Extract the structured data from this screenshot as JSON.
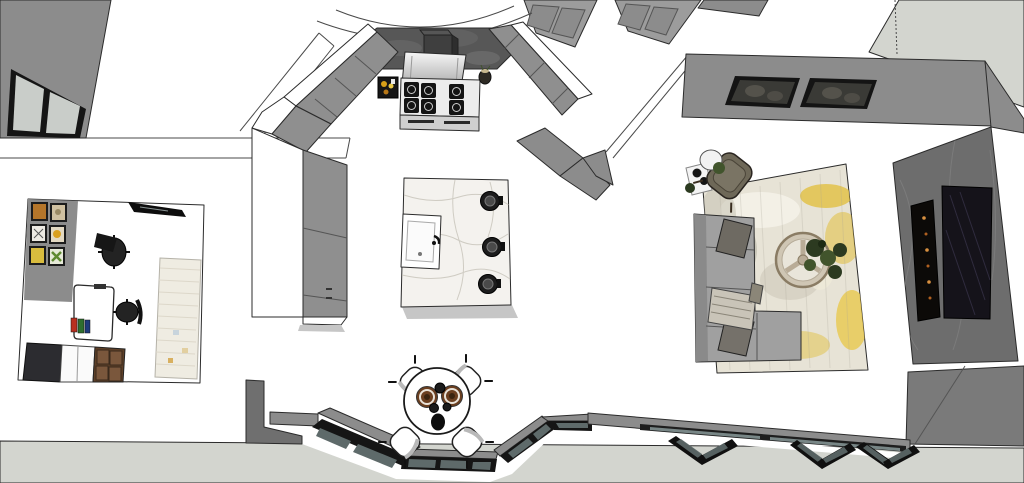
{
  "scene": {
    "label": "3D top-down interior floor plan viewport",
    "rooms": {
      "kitchen": {
        "objects": [
          "range-cooker",
          "range-hood",
          "hood-duct",
          "marble-backsplash",
          "spice-tray",
          "utensil-crock",
          "left-counter",
          "right-counter",
          "kitchen-island",
          "island-sink",
          "bar-stool",
          "bar-stool",
          "bar-stool"
        ]
      },
      "dining": {
        "objects": [
          "round-dining-table",
          "dining-chair",
          "dining-chair",
          "dining-chair",
          "dining-chair",
          "dinner-plate",
          "dinner-plate",
          "black-bowl",
          "black-bowl",
          "black-bowl",
          "vase"
        ]
      },
      "living": {
        "objects": [
          "sectional-sofa",
          "throw-pillow",
          "throw-pillow",
          "knit-blanket",
          "area-rug",
          "round-coffee-table",
          "potted-plants",
          "accent-chair",
          "glass-side-table",
          "wall-artwork",
          "wall-artwork",
          "tv-screen",
          "linear-fireplace",
          "marble-tv-wall"
        ]
      },
      "office": {
        "objects": [
          "gallery-wall-frames",
          "wall-mounted-panel",
          "white-desk",
          "desk-monitor",
          "office-chair",
          "office-chair",
          "books",
          "dark-cabinet",
          "white-shelf-unit",
          "wood-drawers",
          "office-rug"
        ]
      },
      "structure": {
        "objects": [
          "exterior-ground",
          "top-left-wall",
          "top-left-window",
          "pantry-cabinetry",
          "ceiling-arc",
          "bay-window",
          "bifold-windows",
          "living-room-walls",
          "interior-wall-bands"
        ]
      }
    }
  },
  "palette": {
    "outline": "#2b2b2b",
    "line": "#4a4a4a",
    "floor": "#ffffff",
    "exterior": "#d3d5cf",
    "wall": "#8c8c8c",
    "wall-dark": "#6f6f6f",
    "wall-light": "#9c9c9c",
    "counter": "#8f8f8f",
    "backsplash": "#575757",
    "steel-light": "#ececec",
    "steel-mid": "#cfcfcf",
    "burner": "#141414",
    "marble": "#f4f2ee",
    "marble-vein": "#c6c2b8",
    "sink": "#fbfbfb",
    "stool": "#1c1c1c",
    "frame-black": "#151515",
    "glass-ext": "#c9cdc9",
    "bay-glass": "#5e6a6a",
    "chair-shade": "#b9b9b9",
    "plate": "#6b3f20",
    "plate-center": "#3a2410",
    "cup": "#1b1b1b",
    "rug-base": "#e7e3d6",
    "rug-yellow": "#e2c24a",
    "rug-gray": "#b6b2a4",
    "rug-light": "#f4f1e8",
    "sofa": "#a0a0a0",
    "sofa-dark": "#8a8a8a",
    "pillow": "#6e6a62",
    "blanket": "#c9c4b8",
    "coffee-table": "#cfc6b4",
    "coffee-rim": "#8a7c64",
    "plant": "#2c3a20",
    "plant-light": "#41542c",
    "tvwall": "#6d6d6d",
    "tvwall-vein": "#818181",
    "tv": "#15131a",
    "fireplace": "#0c0a08",
    "flame": "#d89040",
    "art-frame": "#141414",
    "art-fill": "#3a3a36",
    "art-light": "#6e6a60",
    "office-rug": "#efece2",
    "drawer": "#5e4028",
    "drawer-light": "#7a573c",
    "cabinet-dark": "#2c2c30",
    "unit-white": "#fafafa",
    "accent-chair": "#6e6858",
    "accent-frame": "#2a2520",
    "desk": "#ffffff",
    "book-red": "#b83020",
    "book-green": "#2e6e2e",
    "book-blue": "#1e3a7a",
    "art1": "#b5762a",
    "art2": "#cfc0a0",
    "art3": "#ece9e2",
    "art4": "#e3d9c2",
    "art5": "#d9bc3e",
    "art6": "#e6ead8",
    "shadow": "#c6c6c6",
    "glass-slit": "#8fa0a0"
  }
}
